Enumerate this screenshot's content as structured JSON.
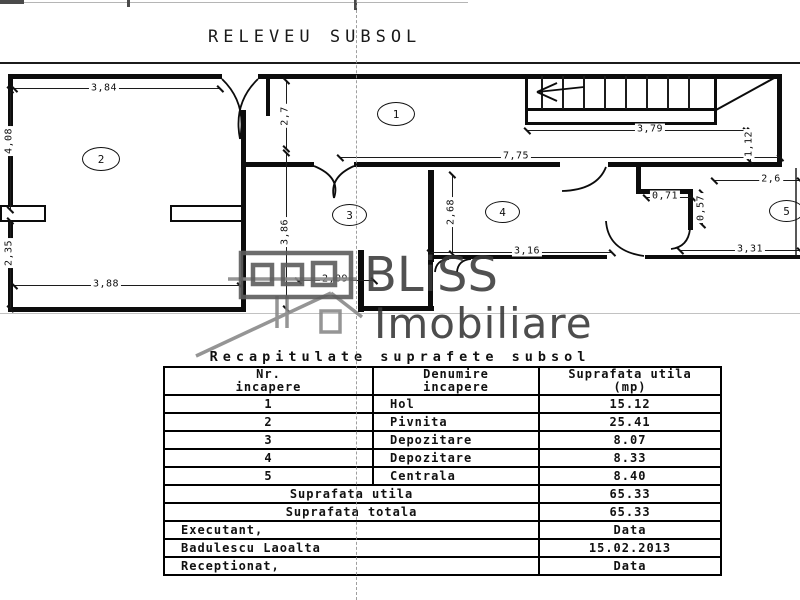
{
  "title": "RELEVEU SUBSOL",
  "watermark": {
    "brand": "BLiSS",
    "brand_line2": "Imobiliare"
  },
  "plan": {
    "rooms": [
      "1",
      "2",
      "3",
      "4",
      "5"
    ],
    "dims": {
      "d384": "3,84",
      "d408": "4,08",
      "d235": "2,35",
      "d388": "3,88",
      "d27": "2,7",
      "d386": "3,86",
      "d209": "2,09",
      "d775": "7,75",
      "d379": "3,79",
      "d112": "1,12",
      "d268": "2,68",
      "d316": "3,16",
      "d071": "0,71",
      "d057": "0,57",
      "d26": "2,6",
      "d331": "3,31"
    }
  },
  "table": {
    "title": "Recapitulate suprafete subsol",
    "headers": {
      "col1_line1": "Nr.",
      "col1_line2": "incapere",
      "col2_line1": "Denumire",
      "col2_line2": "incapere",
      "col3_line1": "Suprafata utila",
      "col3_line2": "(mp)"
    },
    "rows": [
      {
        "nr": "1",
        "name": "Hol",
        "area": "15.12"
      },
      {
        "nr": "2",
        "name": "Pivnita",
        "area": "25.41"
      },
      {
        "nr": "3",
        "name": "Depozitare",
        "area": "8.07"
      },
      {
        "nr": "4",
        "name": "Depozitare",
        "area": "8.33"
      },
      {
        "nr": "5",
        "name": "Centrala",
        "area": "8.40"
      }
    ],
    "summary": [
      {
        "label": "Suprafata utila",
        "value": "65.33"
      },
      {
        "label": "Suprafata totala",
        "value": "65.33"
      },
      {
        "label": "Executant,",
        "value": "Data"
      },
      {
        "label": "Badulescu Laoalta",
        "value": "15.02.2013"
      },
      {
        "label": "Receptionat,",
        "value": "Data"
      }
    ]
  }
}
